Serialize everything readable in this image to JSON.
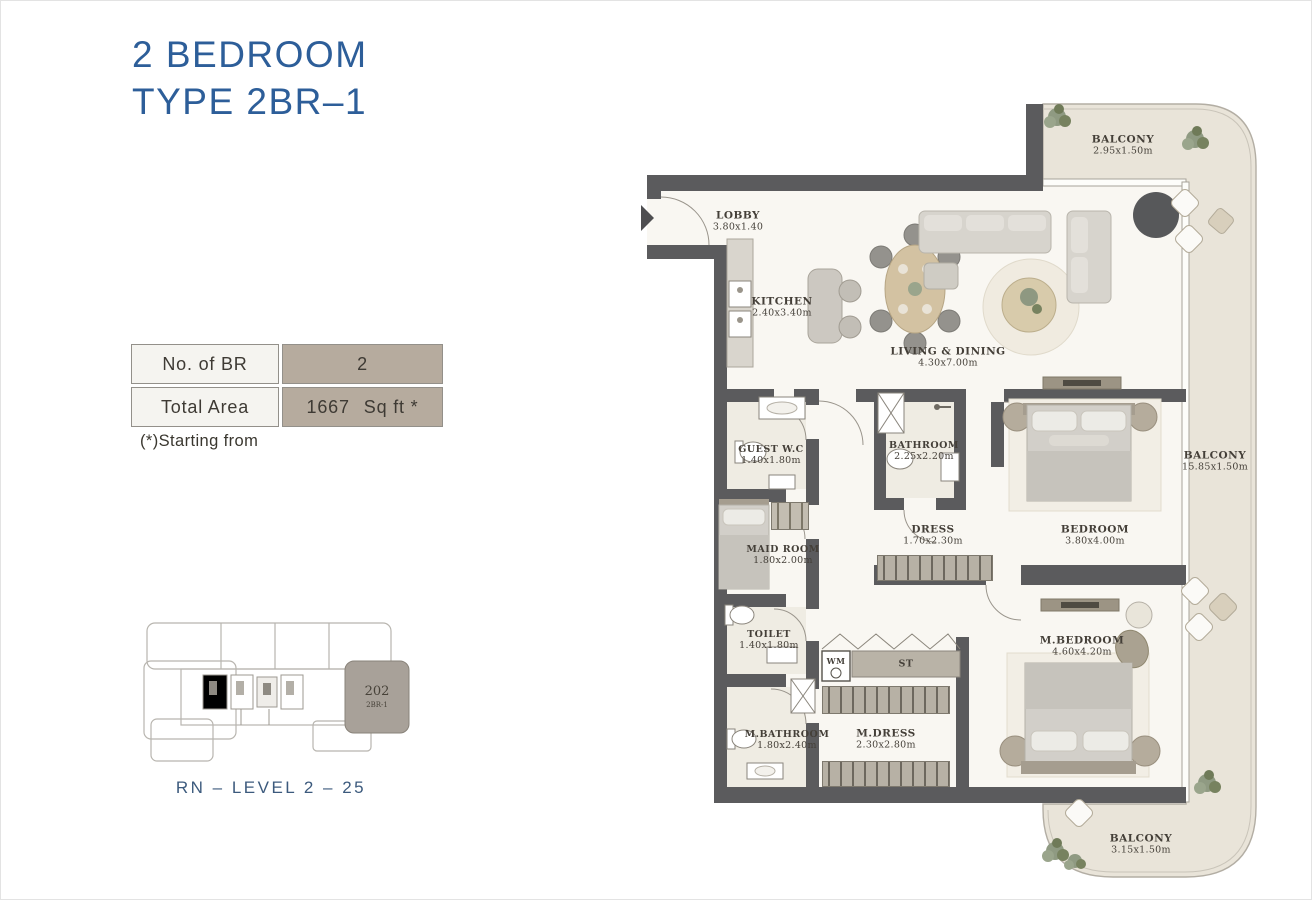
{
  "title": {
    "line1": "2 BEDROOM",
    "line2": "TYPE 2BR–1"
  },
  "spec_table": {
    "rows": [
      {
        "label": "No. of BR",
        "value": "2",
        "unit": ""
      },
      {
        "label": "Total Area",
        "value": "1667",
        "unit": "Sq ft *"
      }
    ]
  },
  "note": "(*)Starting from",
  "key_plan": {
    "unit_number": "202",
    "unit_type": "2BR-1",
    "caption": "RN – LEVEL 2 – 25"
  },
  "rooms": {
    "lobby": {
      "name": "LOBBY",
      "dims": "3.80x1.40"
    },
    "kitchen": {
      "name": "KITCHEN",
      "dims": "2.40x3.40m"
    },
    "living": {
      "name": "LIVING & DINING",
      "dims": "4.30x7.00m"
    },
    "balcony_top": {
      "name": "BALCONY",
      "dims": "2.95x1.50m"
    },
    "balcony_right": {
      "name": "BALCONY",
      "dims": "15.85x1.50m"
    },
    "balcony_bottom": {
      "name": "BALCONY",
      "dims": "3.15x1.50m"
    },
    "guest_wc": {
      "name": "GUEST W.C",
      "dims": "1.40x1.80m"
    },
    "bathroom": {
      "name": "BATHROOM",
      "dims": "2.25x2.20m"
    },
    "dress": {
      "name": "DRESS",
      "dims": "1.70x2.30m"
    },
    "bedroom": {
      "name": "BEDROOM",
      "dims": "3.80x4.00m"
    },
    "maid": {
      "name": "MAID ROOM",
      "dims": "1.80x2.00m"
    },
    "toilet": {
      "name": "TOILET",
      "dims": "1.40x1.80m"
    },
    "m_bathroom": {
      "name": "M.BATHROOM",
      "dims": "1.80x2.40m"
    },
    "m_dress": {
      "name": "M.DRESS",
      "dims": "2.30x2.80m"
    },
    "m_bedroom": {
      "name": "M.BEDROOM",
      "dims": "4.60x4.20m"
    }
  },
  "fixtures": {
    "wm": "WM",
    "st": "ST"
  },
  "colors": {
    "accent_blue": "#2d5e99",
    "wall": "#5b5b5d",
    "floor": "#f9f7f2",
    "balcony_floor": "#e9e4d9",
    "table_value_bg": "#b6ab9e",
    "caption_blue": "#3c5a7d"
  }
}
